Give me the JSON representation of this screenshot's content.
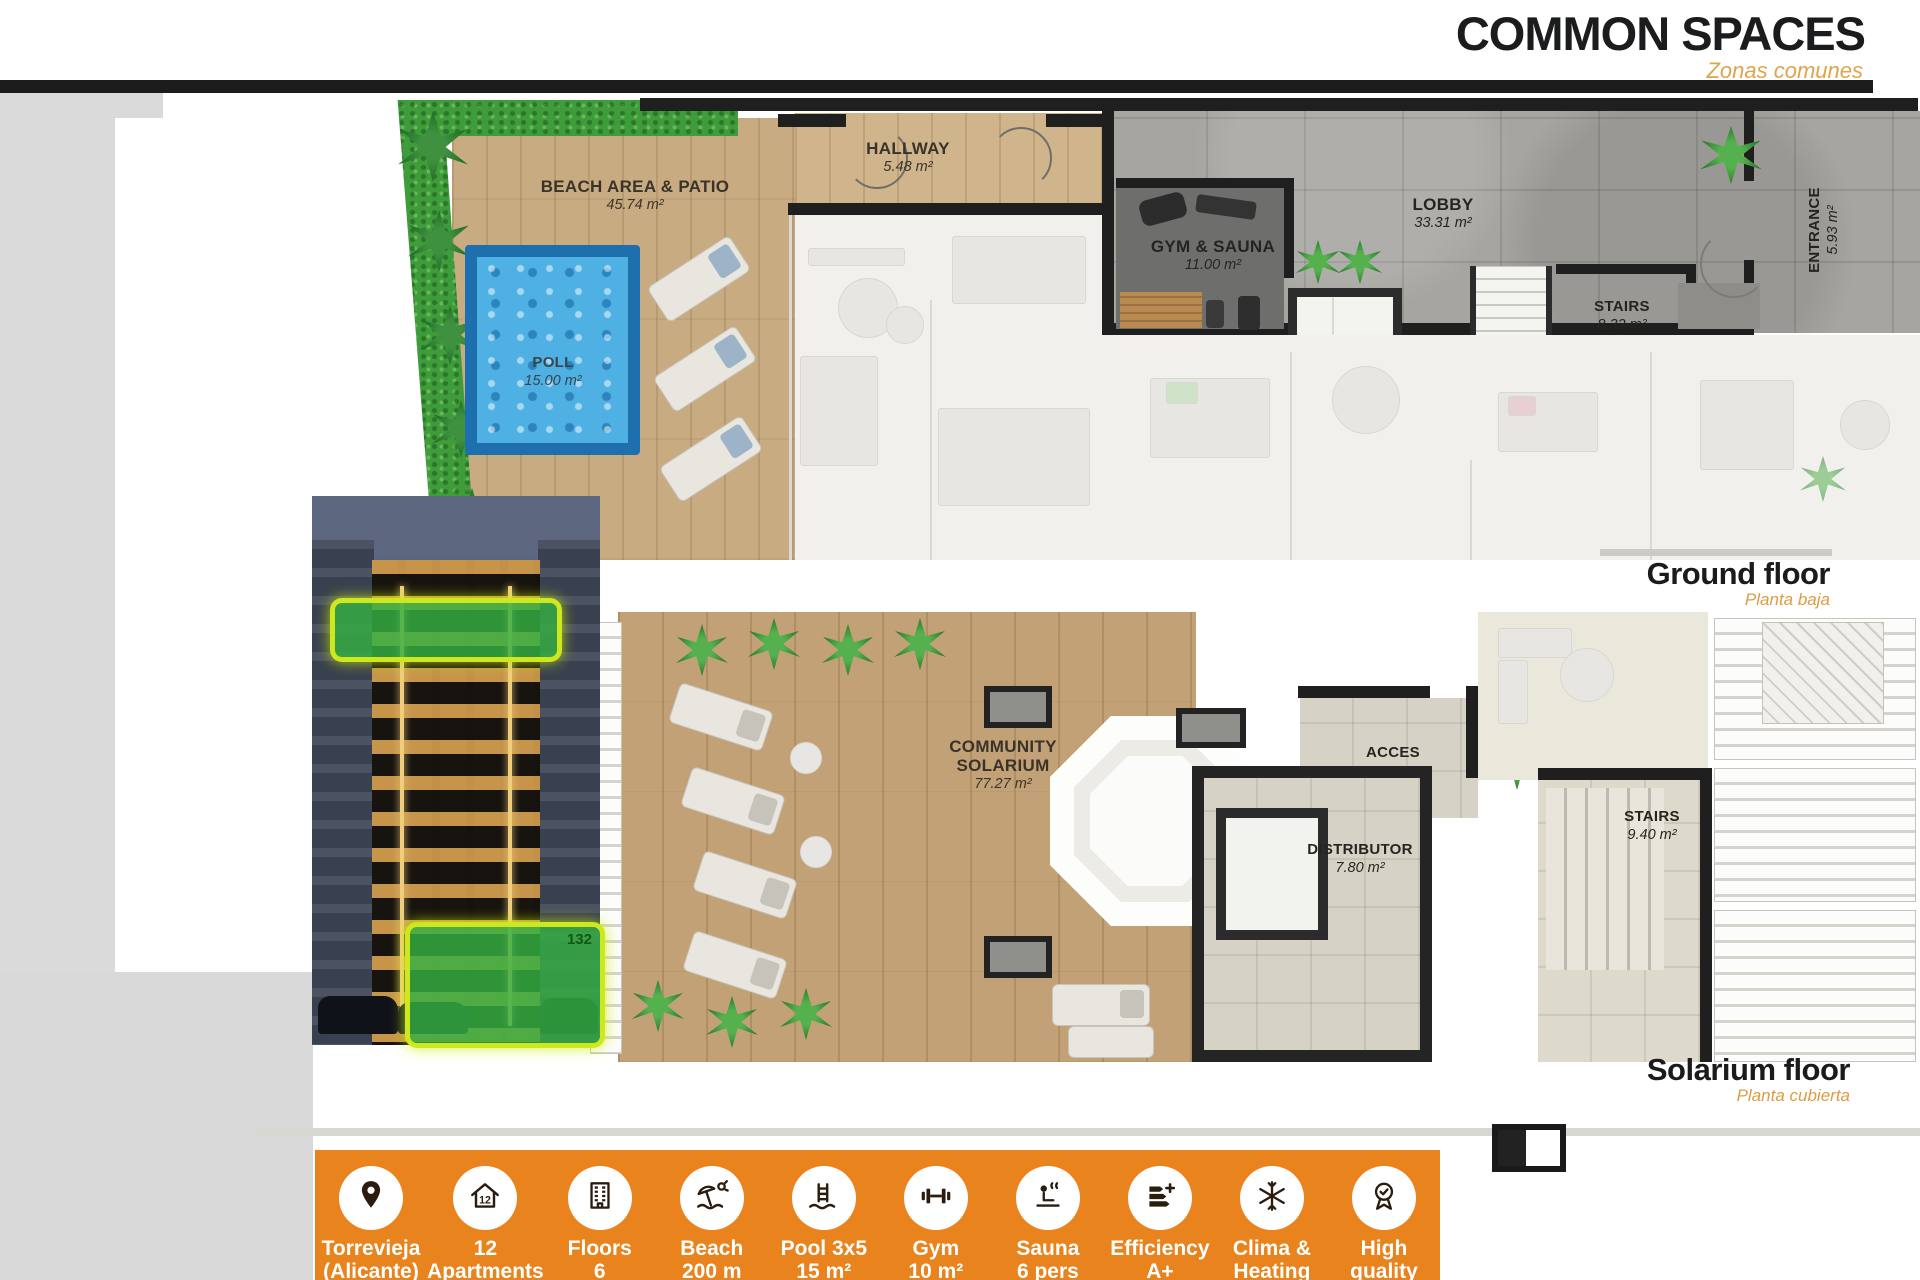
{
  "header": {
    "title": "COMMON SPACES",
    "subtitle": "Zonas comunes"
  },
  "ground_floor": {
    "caption": "Ground floor",
    "caption_es": "Planta baja",
    "beach": {
      "name": "BEACH AREA & PATIO",
      "area": "45.74 m²"
    },
    "pool": {
      "name": "POLL",
      "area": "15.00 m²"
    },
    "hallway": {
      "name": "HALLWAY",
      "area": "5.48 m²"
    },
    "gym": {
      "name": "GYM & SAUNA",
      "area": "11.00 m²"
    },
    "lobby": {
      "name": "LOBBY",
      "area": "33.31 m²"
    },
    "stairs": {
      "name": "STAIRS",
      "area": "8.32 m²"
    },
    "entrance": {
      "name": "ENTRANCE",
      "area": "5.93 m²"
    }
  },
  "solarium_floor": {
    "caption": "Solarium floor",
    "caption_es": "Planta cubierta",
    "solarium": {
      "name": "COMMUNITY SOLARIUM",
      "area": "77.27 m²"
    },
    "acces": {
      "name": "ACCES"
    },
    "distributor": {
      "name": "DISTRIBUTOR",
      "area": "7.80 m²"
    },
    "stairs": {
      "name": "STAIRS",
      "area": "9.40 m²"
    }
  },
  "photo": {
    "badge": "132"
  },
  "features": [
    {
      "icon": "location-pin-icon",
      "line1": "Torrevieja",
      "line2": "(Alicante)"
    },
    {
      "icon": "apartments-icon",
      "line1": "12",
      "line2": "Apartments"
    },
    {
      "icon": "floors-icon",
      "line1": "Floors",
      "line2": "6"
    },
    {
      "icon": "beach-icon",
      "line1": "Beach",
      "line2": "200 m"
    },
    {
      "icon": "pool-ladder-icon",
      "line1": "Pool 3x5",
      "line2": "15 m²"
    },
    {
      "icon": "gym-icon",
      "line1": "Gym",
      "line2": "10 m²"
    },
    {
      "icon": "sauna-icon",
      "line1": "Sauna",
      "line2": "6 pers"
    },
    {
      "icon": "efficiency-icon",
      "line1": "Efficiency",
      "line2": "A+"
    },
    {
      "icon": "clima-icon",
      "line1": "Clima &",
      "line2": "Heating"
    },
    {
      "icon": "quality-icon",
      "line1": "High",
      "line2": "quality"
    }
  ],
  "colors": {
    "accent_orange": "#E8831D",
    "caption_orange": "#DD9C43",
    "wall_black": "#1F1F1F",
    "pool_blue": "#4FB0E3",
    "highlight_green": "#34B042"
  }
}
